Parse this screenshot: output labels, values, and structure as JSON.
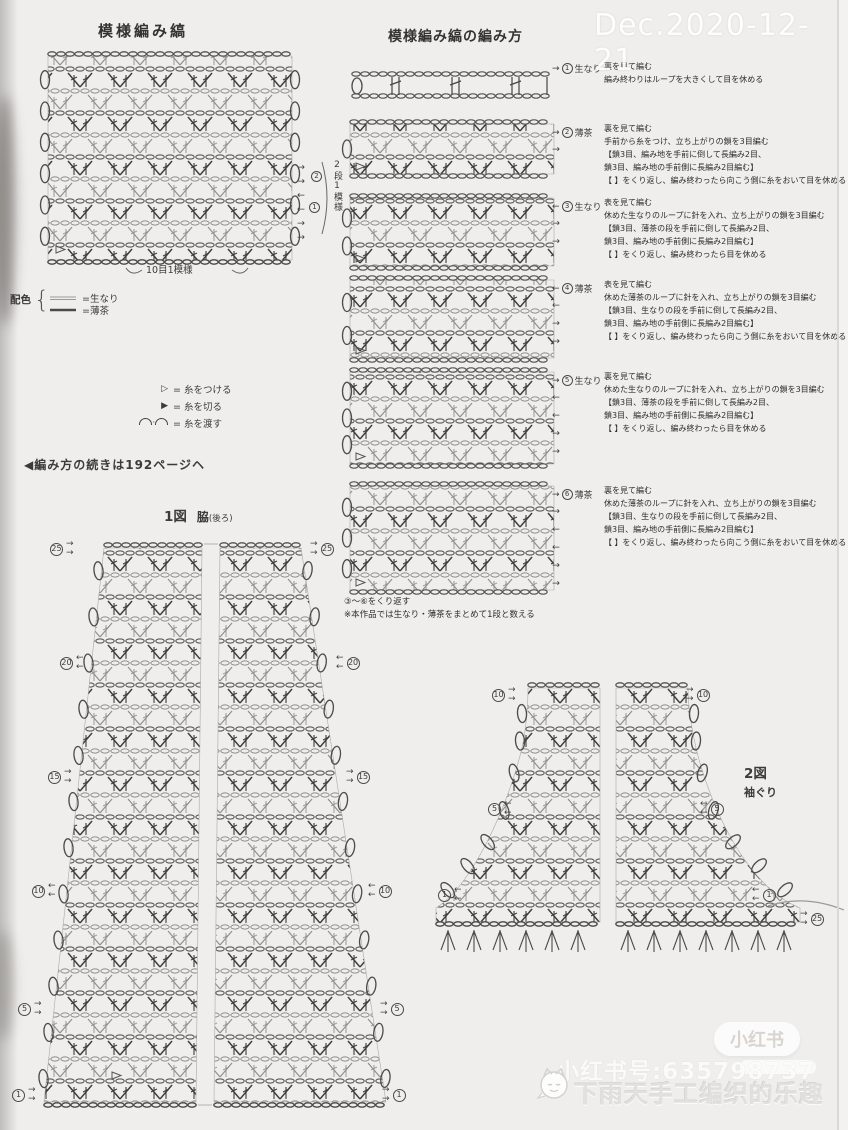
{
  "swatch": {
    "title": "模様編み縞",
    "bottom_label": "10目1模様",
    "repeat_label": "2段1模様",
    "row_markers": [
      {
        "num": "2"
      },
      {
        "num": "1"
      }
    ],
    "side_arrows": [
      "→",
      "→",
      "←",
      "←",
      "→",
      "→"
    ]
  },
  "palette": {
    "label": "配色",
    "items": [
      {
        "text": "=生なり"
      },
      {
        "text": "=薄茶"
      }
    ]
  },
  "legend": {
    "items": [
      {
        "glyph": "▷",
        "text": "= 糸をつける"
      },
      {
        "glyph": "▶",
        "text": "= 糸を切る"
      },
      {
        "glyph": "⌒・⌒",
        "text": "= 糸を渡す"
      }
    ]
  },
  "continue_note": "◀編み方の続きは192ページヘ",
  "howto": {
    "title": "模様編み縞の編み方",
    "steps": [
      {
        "arrow": "→",
        "num": "1",
        "color": "生なり",
        "lines": [
          "裏を見て編む",
          "編み終わりはループを大きくして目を休める"
        ],
        "side_arrows": [
          "→"
        ]
      },
      {
        "arrow": "→",
        "num": "2",
        "color": "薄茶",
        "lines": [
          "裏を見て編む",
          "手前から糸をつけ、立ち上がりの鎖を3目編む",
          "【鎖3目、編み地を手前に倒して長編み2目、",
          "鎖3目、編み地の手前側に長編み2目編む】",
          "【 】をくり返し、編み終わったら向こう側に糸をおいて目を休める"
        ],
        "side_arrows": [
          "→",
          "→"
        ]
      },
      {
        "arrow": "←",
        "num": "3",
        "color": "生なり",
        "lines": [
          "表を見て編む",
          "休めた生なりのループに針を入れ、立ち上がりの鎖を3目編む",
          "【鎖3目、薄茶の段を手前に倒して長編み2目、",
          "鎖3目、編み地の手前側に長編み2目編む】",
          "【 】をくり返し、編み終わったら目を休める"
        ],
        "side_arrows": [
          "←",
          "→",
          "→"
        ]
      },
      {
        "arrow": "←",
        "num": "4",
        "color": "薄茶",
        "lines": [
          "表を見て編む",
          "休めた薄茶のループに針を入れ、立ち上がりの鎖を3目編む",
          "【鎖3目、生なりの段を手前に倒して長編み2目、",
          "鎖3目、編み地の手前側に長編み2目編む】",
          "【 】をくり返し、編み終わったら向こう側に糸をおいて目を休める"
        ],
        "side_arrows": [
          "←",
          "←",
          "→",
          "→"
        ]
      },
      {
        "arrow": "→",
        "num": "5",
        "color": "生なり",
        "lines": [
          "裏を見て編む",
          "休めた生なりのループに針を入れ、立ち上がりの鎖を3目編む",
          "【鎖3目、薄茶の段を手前に倒して長編み2目、",
          "鎖3目、編み地の手前側に長編み2目編む】",
          "【 】をくり返し、編み終わったら目を休める"
        ],
        "side_arrows": [
          "→",
          "←",
          "←",
          "→",
          "→"
        ]
      },
      {
        "arrow": "→",
        "num": "6",
        "color": "薄茶",
        "lines": [
          "裏を見て編む",
          "休めた薄茶のループに針を入れ、立ち上がりの鎖を3目編む",
          "【鎖3目、生なりの段を手前に倒して長編み2目、",
          "鎖3目、編み地の手前側に長編み2目編む】",
          "【 】をくり返し、編み終わったら向こう側に糸をおいて目を休める"
        ],
        "side_arrows": [
          "→",
          "→",
          "←",
          "←",
          "→",
          "→"
        ]
      }
    ],
    "footer": [
      "③～⑥をくり返す",
      "※本作品では生なり・薄茶をまとめて1段と数える"
    ]
  },
  "figure1": {
    "title": "1図",
    "subtitle": "脇",
    "subtitle_paren": "(後ろ)",
    "markers": [
      {
        "num": "25",
        "dir": "→"
      },
      {
        "num": "20",
        "dir": "←"
      },
      {
        "num": "15",
        "dir": "→"
      },
      {
        "num": "10",
        "dir": "←"
      },
      {
        "num": "5",
        "dir": "→"
      },
      {
        "num": "1",
        "dir": "→"
      }
    ]
  },
  "figure2": {
    "title": "2図",
    "subtitle": "袖ぐり",
    "markers_left": [
      {
        "num": "10",
        "dir": "→"
      },
      {
        "num": "5",
        "dir": "←"
      },
      {
        "num": "1",
        "dir": "←"
      }
    ],
    "markers_right": [
      {
        "num": "10",
        "dir": "→"
      },
      {
        "num": "5",
        "dir": "←"
      },
      {
        "num": "1",
        "dir": "←"
      },
      {
        "num": "25",
        "dir": "→"
      }
    ]
  },
  "watermarks": {
    "date": "Dec.2020-12-21",
    "badge": "小红书",
    "account": "小红书号:635798737",
    "caption": "下雨天手工编织的乐趣"
  }
}
